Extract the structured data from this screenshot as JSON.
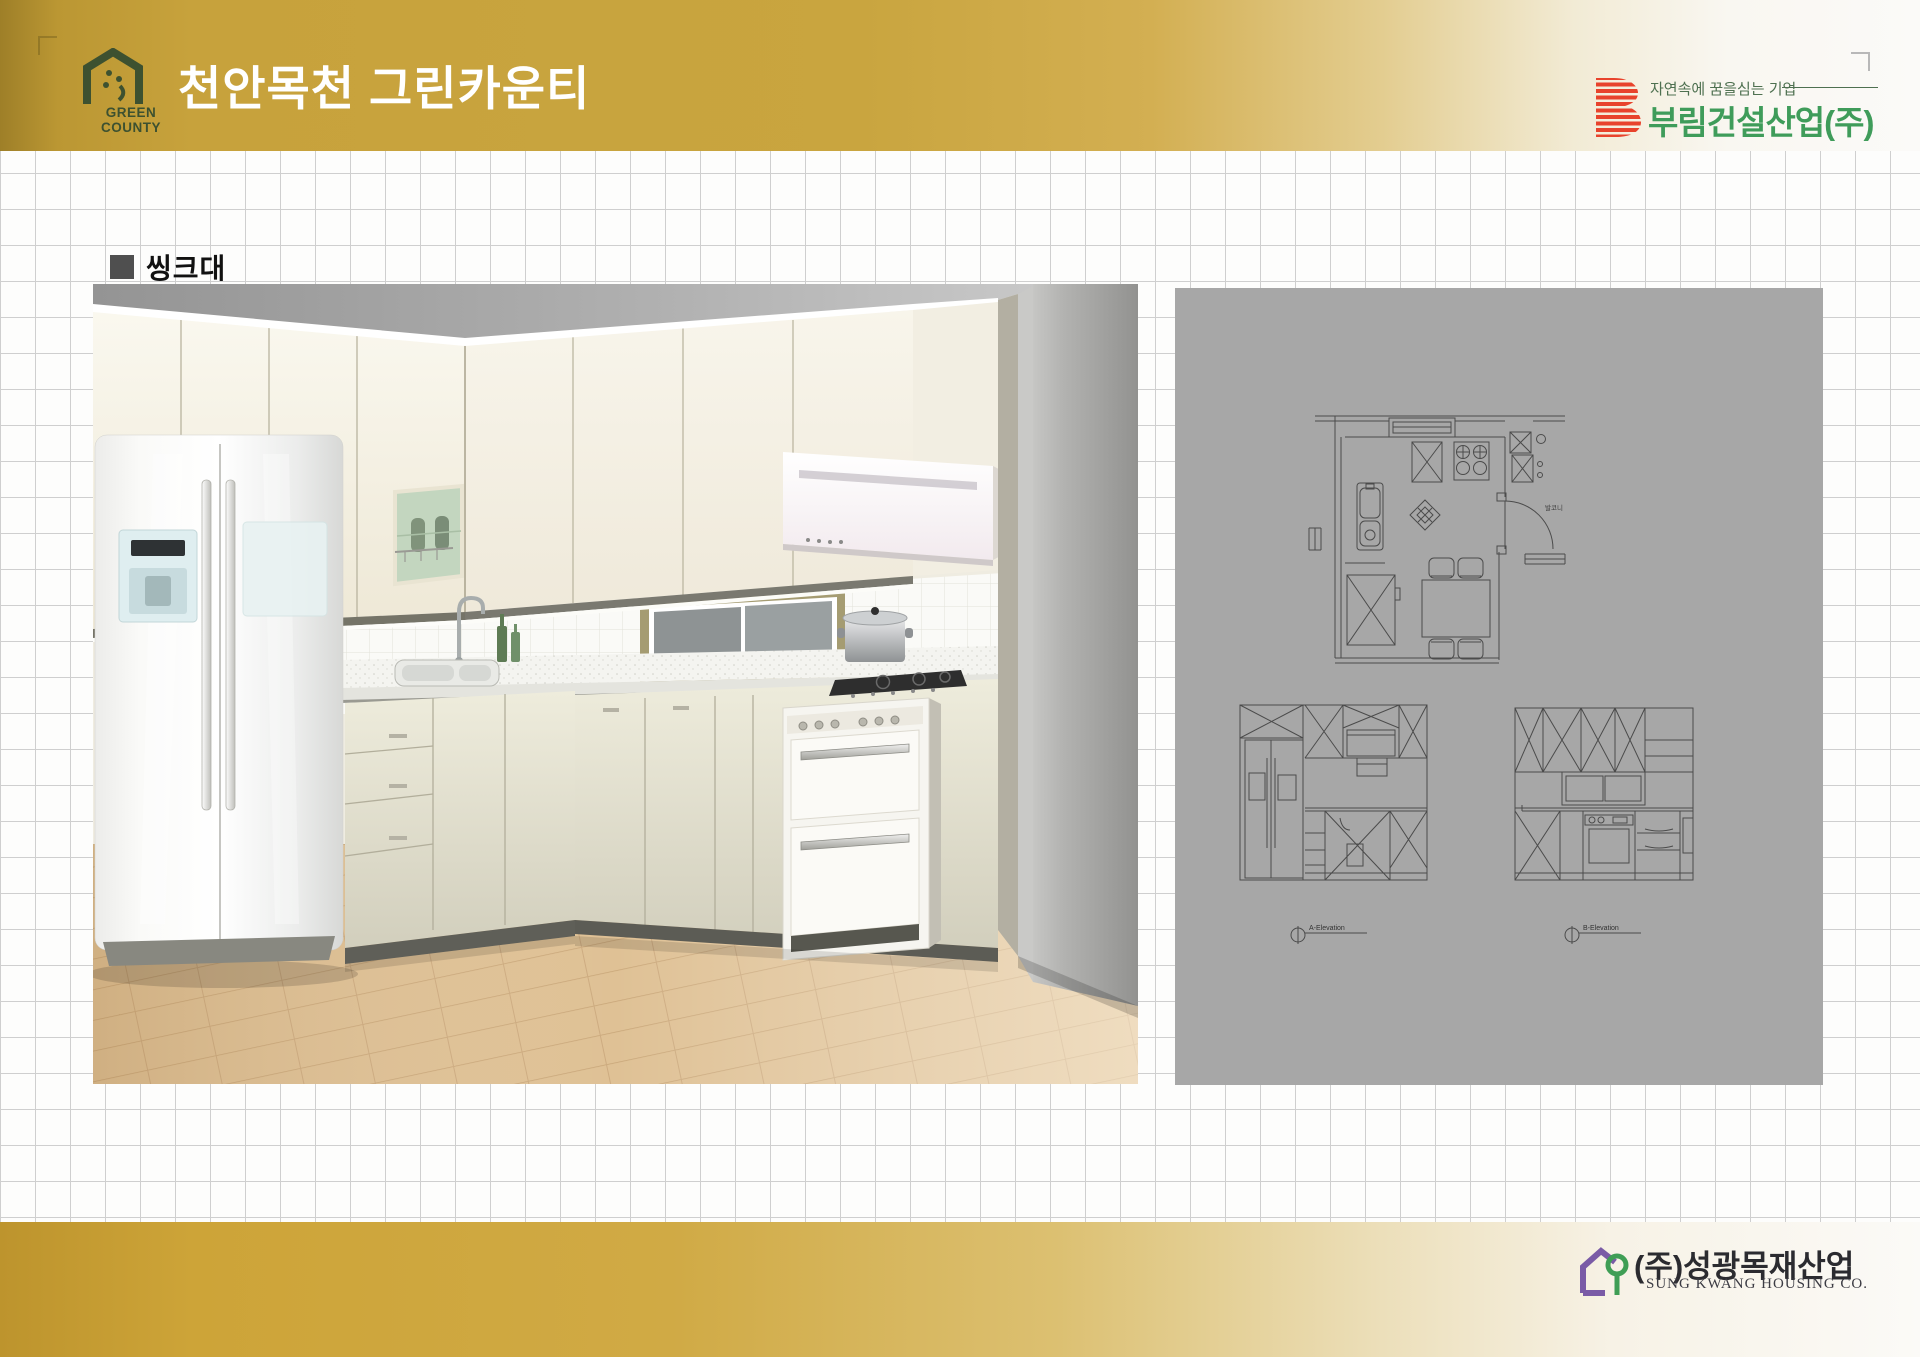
{
  "header": {
    "green_county": {
      "label": "GREEN COUNTY"
    },
    "title": "천안목천 그린카운티",
    "burim": {
      "tagline": "자연속에 꿈을심는 기업",
      "company": "부림건설산업(주)"
    }
  },
  "section": {
    "label": "씽크대"
  },
  "plan_panel": {
    "floor_plan": {
      "room_label": "발코니"
    },
    "elevations": [
      {
        "label": "A-Elevation"
      },
      {
        "label": "B-Elevation"
      }
    ]
  },
  "footer": {
    "sungkwang": {
      "company": "(주)성광목재산업",
      "subtitle": "SUNG KWANG HOUSING CO."
    }
  },
  "colors": {
    "band_gold": "#c8a23c",
    "band_gold_dark": "#9e7f28",
    "title_text": "#ffffff",
    "burim_green": "#3f9c5a",
    "burim_red": "#e8432c",
    "green_county_green": "#3d5130",
    "sungkwang_purple": "#7a5ba6",
    "sungkwang_green": "#3f9e55",
    "panel_gray": "#a7a7a7",
    "grid_line": "#cfcfcf"
  }
}
